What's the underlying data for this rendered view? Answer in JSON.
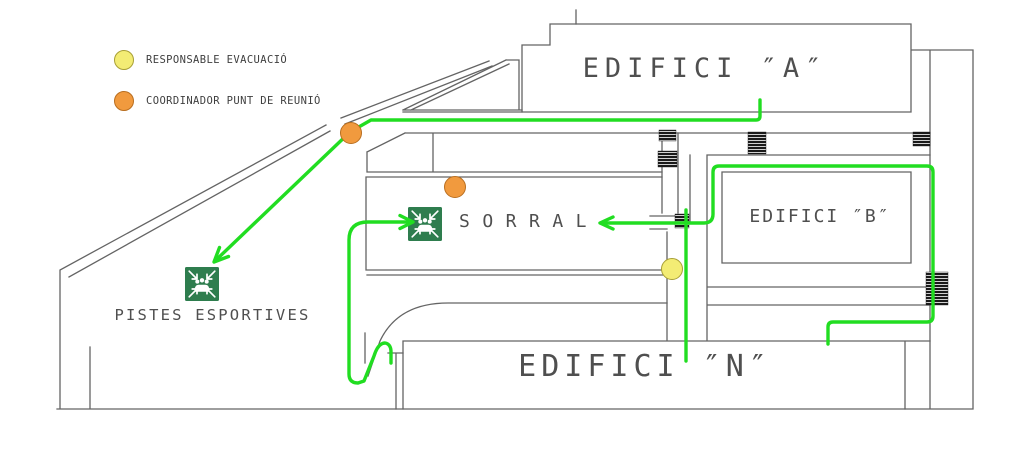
{
  "plan_title": "Evacuation plan",
  "legend": {
    "items": [
      {
        "id": "responsable",
        "label": "RESPONSABLE EVACUACIÓ",
        "fill": "#f3ec74",
        "border": "#a89f35"
      },
      {
        "id": "coordinador",
        "label": "COORDINADOR PUNT DE REUNIÓ",
        "fill": "#f19a3e",
        "border": "#b96e1f"
      }
    ]
  },
  "buildings": {
    "a": {
      "label": "EDIFICI  ″A″"
    },
    "b": {
      "label": "EDIFICI  ″B″"
    },
    "n": {
      "label": "EDIFICI  ″N″"
    }
  },
  "areas": {
    "sorral": {
      "label": "SORRAL"
    },
    "pistes": {
      "label": "PISTES ESPORTIVES"
    }
  },
  "markers": [
    {
      "type": "coordinador",
      "x": 351,
      "y": 133
    },
    {
      "type": "coordinador",
      "x": 455,
      "y": 187
    },
    {
      "type": "responsable",
      "x": 672,
      "y": 269
    }
  ],
  "assembly_points": [
    {
      "id": "pistes-esportives",
      "x": 185,
      "y": 267
    },
    {
      "id": "sorral",
      "x": 408,
      "y": 207
    }
  ],
  "colors": {
    "route": "#21dd21",
    "wall": "#646464",
    "assembly_green": "#2e7d4e",
    "text": "#4f4f4f"
  }
}
